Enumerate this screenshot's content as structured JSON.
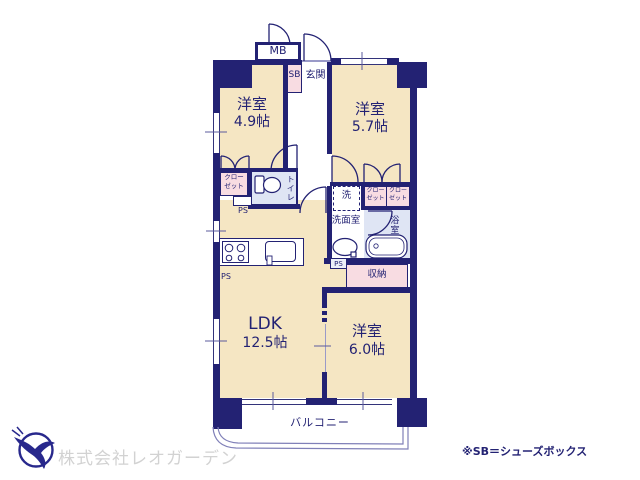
{
  "floorplan": {
    "rooms": {
      "western_49": {
        "name": "洋室",
        "size": "4.9帖"
      },
      "western_57": {
        "name": "洋室",
        "size": "5.7帖"
      },
      "ldk": {
        "name": "LDK",
        "size": "12.5帖"
      },
      "western_60": {
        "name": "洋室",
        "size": "6.0帖"
      }
    },
    "areas": {
      "mb": "MB",
      "sb": "SB",
      "entrance": "玄関",
      "closet_line1": "クロー",
      "closet_line2": "ゼット",
      "toilet": "トイレ",
      "ps": "PS",
      "washer": "洗",
      "washroom": "洗面室",
      "bathroom": "浴室",
      "storage": "収納",
      "balcony": "バルコニー"
    }
  },
  "footer": {
    "company": "株式会社レオガーデン",
    "note": "※SB＝シューズボックス"
  },
  "colors": {
    "wall_navy": "#232273",
    "room_cream": "#f5e6c3",
    "closet_pink": "#f8dce2",
    "wet_blue": "#dfe5f4",
    "company_gray": "#d2d2d2",
    "logo_blue": "#28288c"
  }
}
